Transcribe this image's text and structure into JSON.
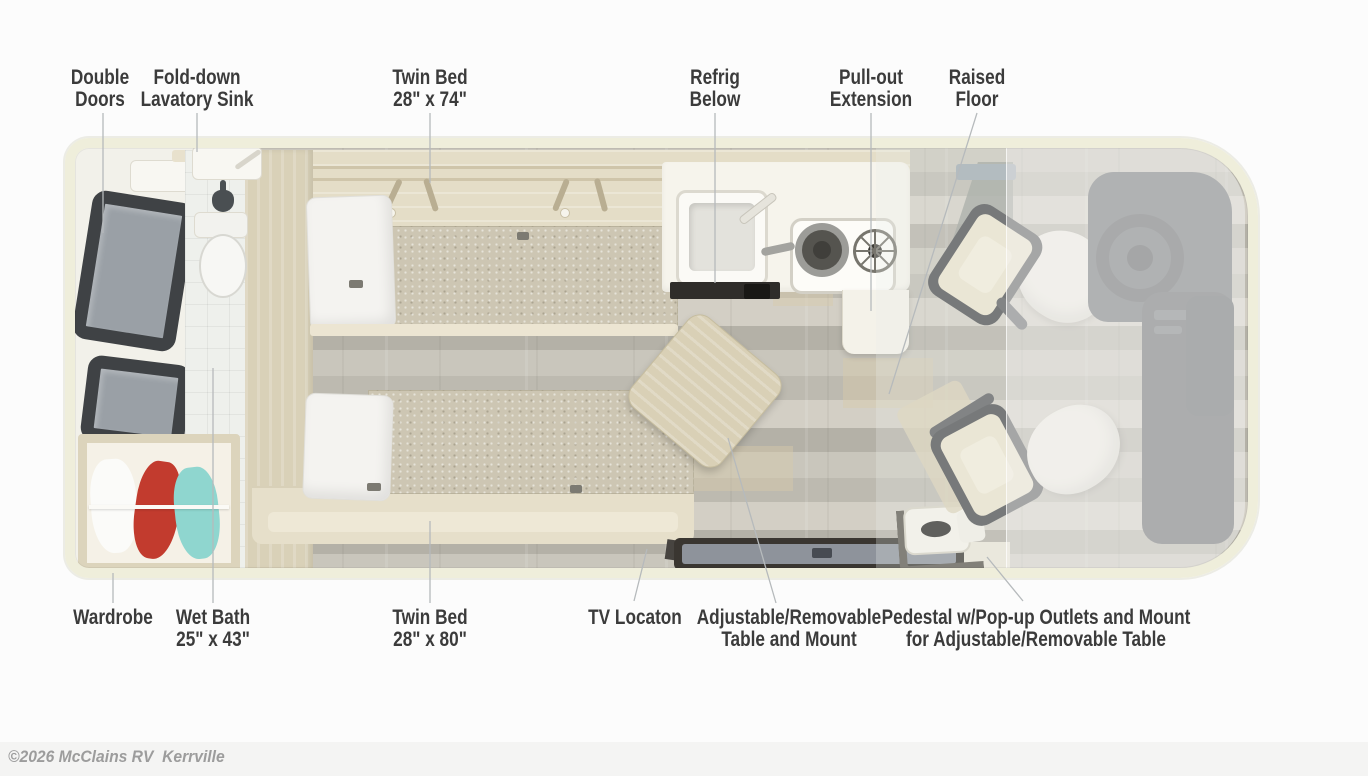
{
  "title": "RV floor plan diagram",
  "copyright": "©2026 McClains RV  Kerrville",
  "labels": {
    "top": [
      {
        "id": "double-doors",
        "line1": "Double",
        "line2": "Doors"
      },
      {
        "id": "fold-down-sink",
        "line1": "Fold-down",
        "line2": "Lavatory Sink"
      },
      {
        "id": "twin-bed-74",
        "line1": "Twin Bed",
        "line2": "28\" x 74\""
      },
      {
        "id": "refrig-below",
        "line1": "Refrig",
        "line2": "Below"
      },
      {
        "id": "pull-out-extension",
        "line1": "Pull-out",
        "line2": "Extension"
      },
      {
        "id": "raised-floor",
        "line1": "Raised",
        "line2": "Floor"
      }
    ],
    "bottom": [
      {
        "id": "wardrobe",
        "line1": "Wardrobe",
        "line2": ""
      },
      {
        "id": "wet-bath",
        "line1": "Wet Bath",
        "line2": "25\" x 43\""
      },
      {
        "id": "twin-bed-80",
        "line1": "Twin Bed",
        "line2": "28\" x 80\""
      },
      {
        "id": "tv-location",
        "line1": "TV Locaton",
        "line2": ""
      },
      {
        "id": "adjustable-table",
        "line1": "Adjustable/Removable",
        "line2": "Table and Mount"
      },
      {
        "id": "pedestal",
        "line1": "Pedestal w/Pop-up Outlets and Mount",
        "line2": "for Adjustable/Removable Table"
      }
    ]
  },
  "floorplan_features": [
    "double entry doors with windows",
    "fold-down lavatory sink",
    "wet bath with toilet and shower",
    "wardrobe with hanging clothes",
    "twin bed 28x74 with pillow",
    "twin bed 28x80 with pillow",
    "overhead cabinets",
    "kitchen counter with sink and two-burner stove",
    "refrigerator below counter",
    "pull-out counter extension",
    "adjustable removable table",
    "tv location panel",
    "pedestal with pop-up outlets",
    "two swivel captain chairs",
    "cab dashboard with steering wheel",
    "raised floor area"
  ],
  "colors": {
    "page_bg": "#fcfcfc",
    "band_bg": "#f4f4f3",
    "label_text": "#3b3b3b",
    "copyright_text": "#9c9c9c",
    "leader": "#b6babc",
    "body_cream": "#efeedb",
    "interior_bg": "#edebe2",
    "left_floor": "#f2f1ea",
    "cabinet_wood": "#e4ddc7",
    "tan_wall": "#d9d1b8",
    "floor_a": "#c9c6bc",
    "floor_b": "#bdbab0",
    "floor_c": "#d3cfc5",
    "floor_d": "#b4b1a7",
    "mattress": "#cdc6b3",
    "pillow": "#f4f3f0",
    "bed_base": "#e6dfca",
    "counter": "#f6f4ec",
    "fridge_dark": "#2f2d2a",
    "table_wood": "#d9d0b6",
    "tv_frame": "#3a3631",
    "tv_screen": "#8e939b",
    "chair_frame": "#4b4d4f",
    "chair_cushion": "#ebe4ce",
    "chair_back": "#f1eee6",
    "dash_dark": "#63666a",
    "console_dark": "#595c60",
    "window_frame": "#3f4245",
    "window_glass": "#9aa0a6",
    "cloth_red": "#c23b2e",
    "cloth_teal": "#8fd6cf",
    "overlay_raised": "rgba(240,241,238,0.55)"
  }
}
